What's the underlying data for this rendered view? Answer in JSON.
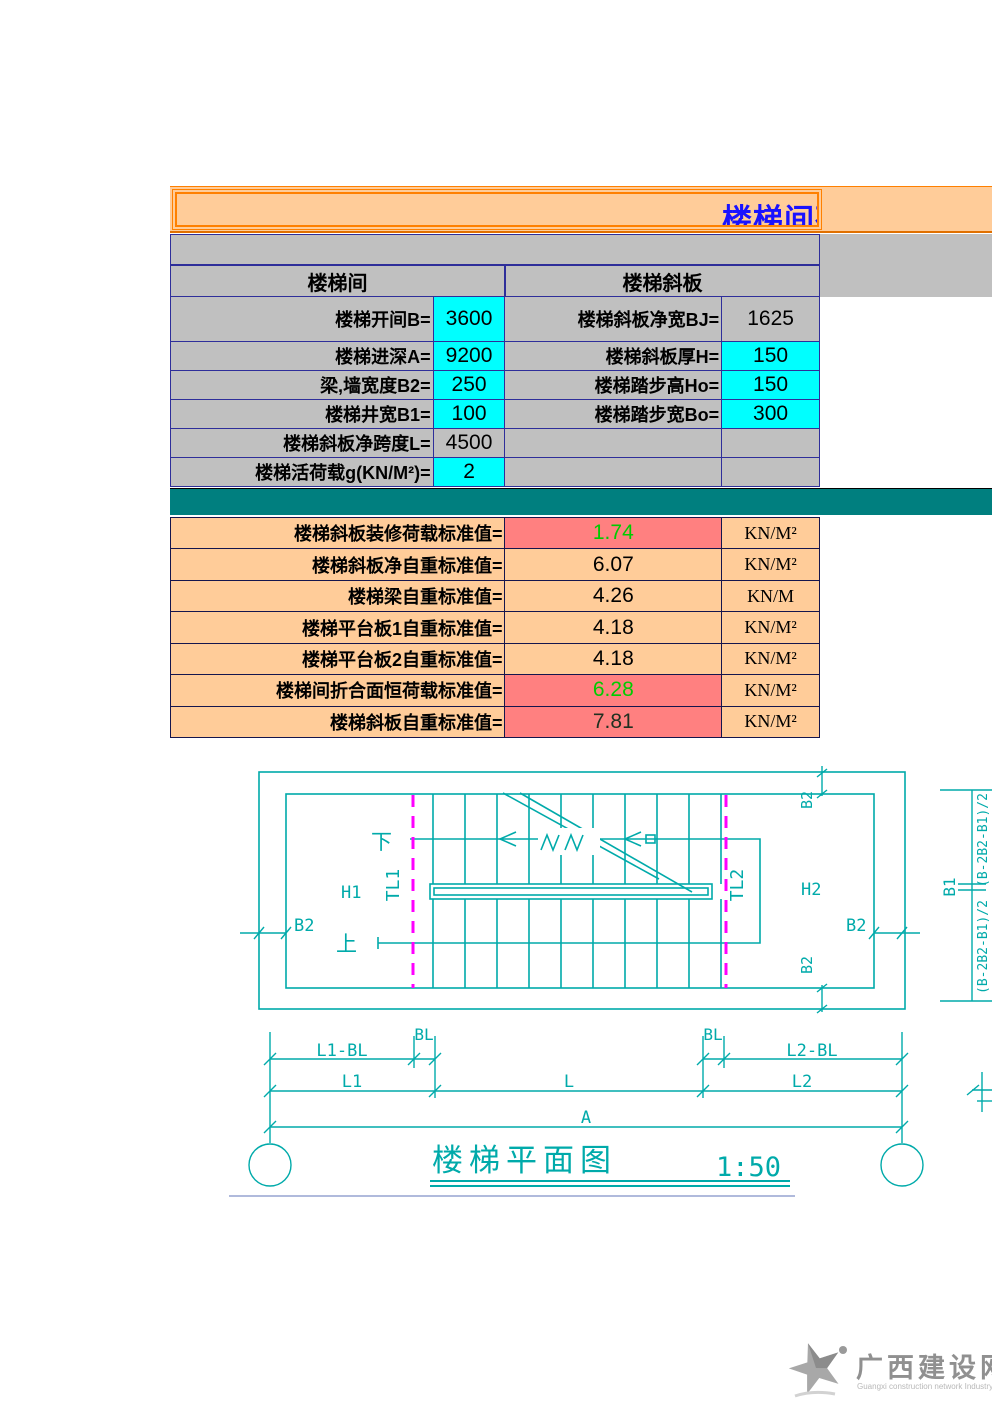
{
  "banner": {
    "title_visible": "楼梯间荷",
    "bg": "#FFCC99",
    "border": "#FF8000",
    "title_color": "#1A12FF"
  },
  "input_table": {
    "section_headers": [
      {
        "label": "楼梯间"
      },
      {
        "label": "楼梯斜板"
      }
    ],
    "rows": [
      {
        "c1_label": "楼梯开间B=",
        "c1_value": "3600",
        "c2_label": "楼梯斜板净宽BJ=",
        "c2_value": "1625"
      },
      {
        "c1_label": "楼梯进深A=",
        "c1_value": "9200",
        "c2_label": "楼梯斜板厚H=",
        "c2_value": "150"
      },
      {
        "c1_label": "梁,墙宽度B2=",
        "c1_value": "250",
        "c2_label": "楼梯踏步高Ho=",
        "c2_value": "150"
      },
      {
        "c1_label": "楼梯井宽B1=",
        "c1_value": "100",
        "c2_label": "楼梯踏步宽Bo=",
        "c2_value": "300"
      },
      {
        "c1_label": "楼梯斜板净跨度L=",
        "c1_value": "4500",
        "c2_label": "",
        "c2_value": ""
      },
      {
        "c1_label": "楼梯活荷载g(KN/M²)=",
        "c1_value": "2",
        "c2_label": "",
        "c2_value": ""
      }
    ]
  },
  "result_table": {
    "rows": [
      {
        "label": "楼梯斜板装修荷载标准值=",
        "value": "1.74",
        "unit": "KN/M²"
      },
      {
        "label": "楼梯斜板净自重标准值=",
        "value": "6.07",
        "unit": "KN/M²"
      },
      {
        "label": "楼梯梁自重标准值=",
        "value": "4.26",
        "unit": "KN/M"
      },
      {
        "label": "楼梯平台板1自重标准值=",
        "value": "4.18",
        "unit": "KN/M²"
      },
      {
        "label": "楼梯平台板2自重标准值=",
        "value": "4.18",
        "unit": "KN/M²"
      },
      {
        "label": "楼梯间折合面恒荷载标准值=",
        "value": "6.28",
        "unit": "KN/M²"
      },
      {
        "label": "楼梯斜板自重标准值=",
        "value": "7.81",
        "unit": "KN/M²"
      }
    ]
  },
  "drawing": {
    "title": "楼梯平面图",
    "scale": "1:50",
    "labels": {
      "down": "下",
      "up": "上",
      "h1": "H1",
      "h2": "H2",
      "b2": "B2",
      "tl1": "TL1",
      "tl2": "TL2",
      "b1": "B1",
      "bl": "BL",
      "l1_bl": "L1-BL",
      "l2_bl": "L2-BL",
      "l1": "L1",
      "l": "L",
      "l2": "L2",
      "a": "A",
      "side_formula": "(B-2B2-B1)/2"
    },
    "line_color": "#00AAAA",
    "beam_line_color": "#FF00FF"
  },
  "footer": {
    "site_name": "广西建设网",
    "tagline": "Guangxi construction network Industry Edition"
  },
  "colors": {
    "input_cell": "#00FFFF",
    "table_bg": "#C0C0C0",
    "band": "#007F7F",
    "result_bg": "#FFCC99",
    "highlight_bg": "#FF8080",
    "highlight_text": "#00CC00",
    "grid_border": "#2E2E9A"
  }
}
